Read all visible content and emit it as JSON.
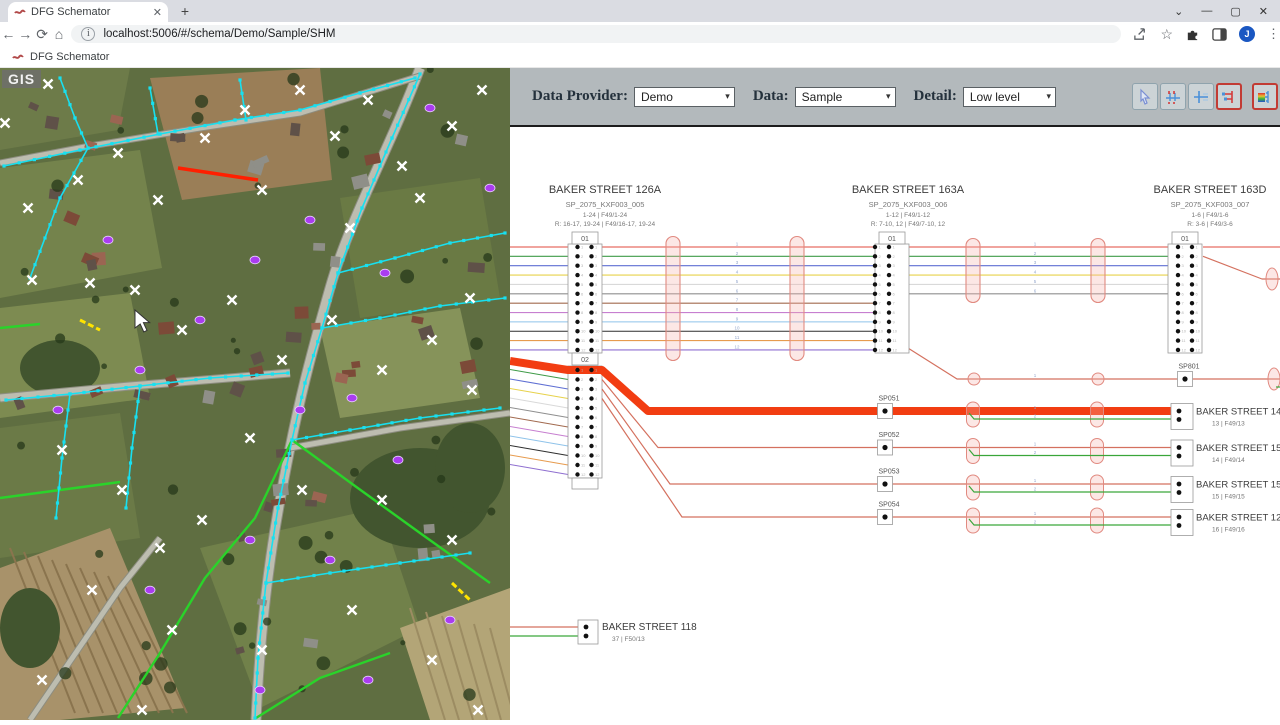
{
  "browser": {
    "tab_title": "DFG Schemator",
    "new_tab": "+",
    "url": "localhost:5006/#/schema/Demo/Sample/SHM",
    "bookmark_label": "DFG Schemator",
    "avatar_initial": "J",
    "win_min": "—",
    "win_max": "▢",
    "win_close": "✕",
    "win_chevron": "⌄",
    "back": "←",
    "forward": "→",
    "reload": "⟳",
    "home": "⌂",
    "info": "i",
    "star": "☆",
    "menu": "⋮"
  },
  "toolbar": {
    "data_provider_label": "Data Provider:",
    "data_provider_value": "Demo",
    "data_label": "Data:",
    "data_value": "Sample",
    "detail_label": "Detail:",
    "detail_value": "Low level"
  },
  "map": {
    "watermark": "GIS"
  },
  "schematic": {
    "fiber_colors": [
      "#e2483d",
      "#3f9b48",
      "#5f6fd3",
      "#e7d24b",
      "#d9d9d9",
      "#8f8f8f",
      "#a26a4f",
      "#c77fd0",
      "#8fc3ea",
      "#2f2f2f",
      "#e79b4e",
      "#8f6fd0"
    ],
    "upper_blocks": [
      {
        "title": "BAKER STREET 126A",
        "code": "SP_2075_KXF003_005",
        "line1": "1-24 | F49/1-24",
        "line2": "R: 16-17, 19-24 | F49/16-17, 19-24",
        "port": "01"
      },
      {
        "title": "BAKER STREET 163A",
        "code": "SP_2075_KXF003_006",
        "line1": "1-12 | F49/1-12",
        "line2": "R: 7-10, 12 | F49/7-10, 12",
        "port": "01"
      },
      {
        "title": "BAKER STREET 163D",
        "code": "SP_2075_KXF003_007",
        "line1": "1-6 | F49/1-6",
        "line2": "R: 3-6 | F49/3-6",
        "port": "01"
      }
    ],
    "block02_port": "02",
    "sp_rows": [
      {
        "label": "SP051",
        "street": "BAKER STREET 14",
        "sub": "13 | F49/13",
        "thick": true
      },
      {
        "label": "SP052",
        "street": "BAKER STREET 15",
        "sub": "14 | F49/14",
        "thick": false
      },
      {
        "label": "SP053",
        "street": "BAKER STREET 15",
        "sub": "15 | F49/15",
        "thick": false
      },
      {
        "label": "SP054",
        "street": "BAKER STREET 12",
        "sub": "16 | F49/16",
        "thick": false
      }
    ],
    "sp801_label": "SP801",
    "bottom_block": {
      "street": "BAKER STREET 118",
      "sub": "37 | F50/13"
    },
    "colors": {
      "highlight": "#f23d12",
      "thin_red": "#d4715f",
      "green": "#3aa63a",
      "oval_stroke": "#e18a80",
      "oval_fill": "rgba(244,176,168,0.30)",
      "tiny_num": "#94a7cc"
    }
  }
}
